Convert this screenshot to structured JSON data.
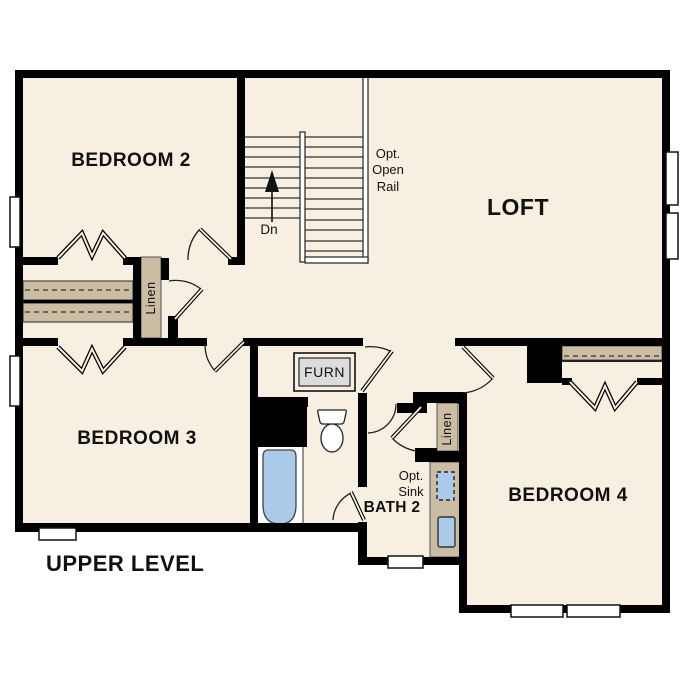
{
  "title": "UPPER LEVEL",
  "rooms": {
    "bedroom2": "BEDROOM 2",
    "bedroom3": "BEDROOM 3",
    "bedroom4": "BEDROOM 4",
    "loft": "LOFT",
    "bath": "BATH 2"
  },
  "labels": {
    "stairs_direction": "Dn",
    "opt_open_rail": "Opt. Open Rail",
    "opt_sink": "Opt. Sink",
    "linen_hall": "Linen",
    "linen_bath": "Linen",
    "furnace": "FURN"
  },
  "colors": {
    "floor": "#f7efe2",
    "cabinet_tan": "#cbbca4",
    "fixture_blue": "#abc9e9",
    "wall": "#000000",
    "furnace_gray": "#dcdcdc",
    "text": "#111111",
    "background": "#ffffff"
  }
}
